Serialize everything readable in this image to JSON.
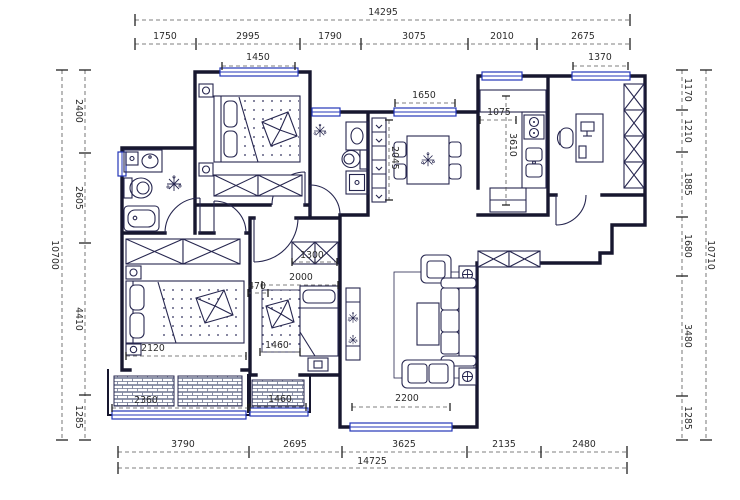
{
  "drawing": {
    "kind": "apartment-floor-plan"
  },
  "colors": {
    "wall": "#17172f",
    "furniture": "#26264f",
    "window_accent": "#2336b8",
    "dimension_line": "#555555",
    "dimension_text": "#2b2b2b",
    "hatch": "#6b7390",
    "background": "#ffffff"
  },
  "dimension_chains": [
    {
      "name": "top-total",
      "orient": "h",
      "line": 20,
      "from": 135,
      "to": 630,
      "ticks": [
        135,
        630
      ],
      "labels": [
        {
          "text": "14295",
          "x": 383,
          "y": 15
        }
      ]
    },
    {
      "name": "top-segments",
      "orient": "h",
      "line": 44,
      "from": 135,
      "to": 630,
      "ticks": [
        135,
        196,
        300,
        361,
        468,
        537,
        630
      ],
      "labels": [
        {
          "text": "1750",
          "x": 165,
          "y": 39
        },
        {
          "text": "2995",
          "x": 248,
          "y": 39
        },
        {
          "text": "1790",
          "x": 330,
          "y": 39
        },
        {
          "text": "3075",
          "x": 414,
          "y": 39
        },
        {
          "text": "2010",
          "x": 502,
          "y": 39
        },
        {
          "text": "2675",
          "x": 583,
          "y": 39
        }
      ]
    },
    {
      "name": "bottom-segments",
      "orient": "h",
      "line": 452,
      "from": 118,
      "to": 627,
      "ticks": [
        118,
        249,
        342,
        467,
        541,
        627
      ],
      "labels": [
        {
          "text": "3790",
          "x": 183,
          "y": 447
        },
        {
          "text": "2695",
          "x": 295,
          "y": 447
        },
        {
          "text": "3625",
          "x": 404,
          "y": 447
        },
        {
          "text": "2135",
          "x": 504,
          "y": 447
        },
        {
          "text": "2480",
          "x": 584,
          "y": 447
        }
      ]
    },
    {
      "name": "bottom-total",
      "orient": "h",
      "line": 468,
      "from": 118,
      "to": 627,
      "ticks": [
        118,
        627
      ],
      "labels": [
        {
          "text": "14725",
          "x": 372,
          "y": 464
        }
      ]
    },
    {
      "name": "left-total",
      "orient": "v",
      "line": 62,
      "from": 70,
      "to": 440,
      "ticks": [
        70,
        440
      ],
      "labels": [
        {
          "text": "10700",
          "x": 52,
          "y": 255,
          "rot": 90
        }
      ]
    },
    {
      "name": "left-segments",
      "orient": "v",
      "line": 85,
      "from": 70,
      "to": 440,
      "ticks": [
        70,
        153,
        243,
        395,
        440
      ],
      "labels": [
        {
          "text": "2400",
          "x": 76,
          "y": 111,
          "rot": 90
        },
        {
          "text": "2605",
          "x": 76,
          "y": 198,
          "rot": 90
        },
        {
          "text": "4410",
          "x": 76,
          "y": 319,
          "rot": 90
        },
        {
          "text": "1285",
          "x": 76,
          "y": 417,
          "rot": 90
        }
      ]
    },
    {
      "name": "right-segments",
      "orient": "v",
      "line": 682,
      "from": 70,
      "to": 440,
      "ticks": [
        70,
        110,
        152,
        217,
        276,
        396,
        440
      ],
      "labels": [
        {
          "text": "1170",
          "x": 685,
          "y": 90,
          "rot": 90
        },
        {
          "text": "1210",
          "x": 685,
          "y": 131,
          "rot": 90
        },
        {
          "text": "1885",
          "x": 685,
          "y": 184,
          "rot": 90
        },
        {
          "text": "1680",
          "x": 685,
          "y": 246,
          "rot": 90
        },
        {
          "text": "3480",
          "x": 685,
          "y": 336,
          "rot": 90
        },
        {
          "text": "1285",
          "x": 685,
          "y": 418,
          "rot": 90
        }
      ]
    },
    {
      "name": "right-total",
      "orient": "v",
      "line": 706,
      "from": 70,
      "to": 440,
      "ticks": [
        70,
        440
      ],
      "labels": [
        {
          "text": "10710",
          "x": 708,
          "y": 255,
          "rot": 90
        }
      ]
    }
  ],
  "interior_dimensions": [
    {
      "text": "1450",
      "x": 258,
      "y": 60,
      "line": [
        222,
        66,
        295,
        66
      ]
    },
    {
      "text": "1370",
      "x": 600,
      "y": 60,
      "line": [
        573,
        66,
        628,
        66
      ]
    },
    {
      "text": "1650",
      "x": 424,
      "y": 98,
      "line": [
        395,
        103,
        455,
        103
      ]
    },
    {
      "text": "1075",
      "x": 499,
      "y": 115,
      "line": [
        480,
        120,
        516,
        120
      ]
    },
    {
      "text": "3610",
      "x": 510,
      "y": 145,
      "rot": 90,
      "line": [
        506,
        96,
        506,
        205
      ]
    },
    {
      "text": "2045",
      "x": 392,
      "y": 158,
      "rot": 90,
      "line": [
        389,
        120,
        389,
        200
      ]
    },
    {
      "text": "2120",
      "x": 153,
      "y": 351,
      "line": [
        126,
        356,
        246,
        356
      ]
    },
    {
      "text": "2360",
      "x": 146,
      "y": 403,
      "line": [
        112,
        408,
        248,
        408
      ]
    },
    {
      "text": "1300",
      "x": 312,
      "y": 258,
      "line": [
        292,
        262,
        337,
        262
      ]
    },
    {
      "text": "2000",
      "x": 301,
      "y": 280,
      "line": [
        262,
        285,
        338,
        285
      ]
    },
    {
      "text": "470",
      "x": 257,
      "y": 289,
      "line": [
        248,
        293,
        268,
        293
      ]
    },
    {
      "text": "1460",
      "x": 277,
      "y": 348,
      "line": [
        260,
        352,
        300,
        352
      ]
    },
    {
      "text": "1460",
      "x": 280,
      "y": 402,
      "line": [
        250,
        407,
        306,
        407
      ]
    },
    {
      "text": "2200",
      "x": 407,
      "y": 401,
      "line": [
        352,
        407,
        450,
        407
      ]
    }
  ]
}
